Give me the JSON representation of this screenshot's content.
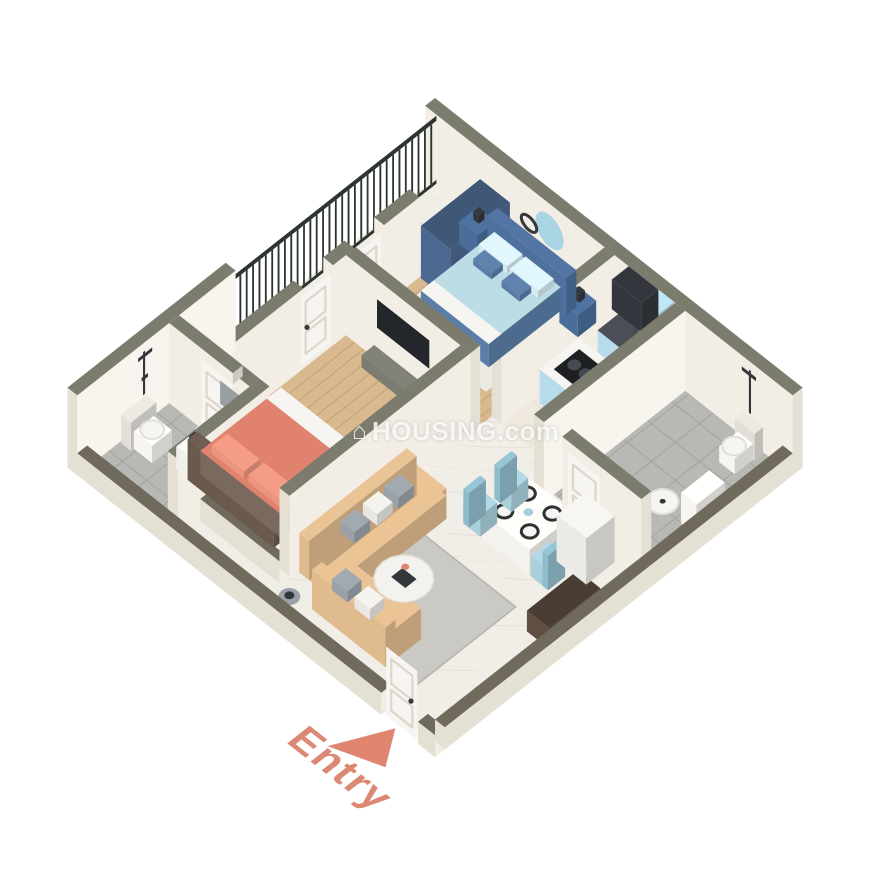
{
  "labels": {
    "entry": "Entry"
  },
  "watermark": {
    "icon": "⌂",
    "text": "HOUSING.com"
  },
  "scene": {
    "rooms": [
      "balcony",
      "bedroom-1",
      "bathroom-1",
      "bedroom-2",
      "living-dining",
      "kitchen",
      "bathroom-2",
      "entry"
    ],
    "furniture": [
      "double-bed-blue",
      "double-bed-salmon",
      "wardrobe",
      "tv-unit",
      "l-shaped-sofa",
      "coffee-table",
      "dining-table-four-chairs",
      "kitchen-island-hob",
      "kitchen-counter-sink",
      "overhead-cabinet",
      "refrigerator-cabinet",
      "toilets",
      "washbasins",
      "showers",
      "balcony-railing",
      "sideboard",
      "nightstands",
      "dresser"
    ]
  },
  "colors": {
    "background": "#ffffff",
    "wallTop": "#7b7c6e",
    "wallTopLow": "#6f6a5c",
    "wallFace": "#f2eee5",
    "wallFaceShade": "#e5e0d4",
    "wallFaceInner": "#f8f5ef",
    "floorWood": "#d9b98e",
    "floorWoodStripe": "#c2a074",
    "floorMarble": "#f1eee7",
    "floorMarbleVein": "#ddd8cc",
    "floorKitchen": "#efe9df",
    "floorKitchenLine": "#e0d9c9",
    "floorTile": "#b8b8b4",
    "floorTileLine": "#a3a39f",
    "railing": "#2c3530",
    "rugLight": "#eceae4",
    "rugGray": "#c7c5c0",
    "rugLiving": "#cbc9c4",
    "rugBorder": "#b9b7b1",
    "bedBlueFrame": "#5b7da8",
    "bedBlueHead": "#4f6f9c",
    "bedBlueBlanket": "#bcdde6",
    "bedBluePillow": "#d6ebf1",
    "bedBlueAccent": "#5a7ca6",
    "nightBlue": "#4a6d9a",
    "wardrobe": "#4d6890",
    "wardrobeTop": "#3f5878",
    "mirrorBlue": "#a8d4e4",
    "mirrorGray": "#9aa0a2",
    "darkRing": "#33363a",
    "bedSalmon": "#e0826e",
    "bedSalmonPillow": "#e9957f",
    "bedBrownHead": "#6a5a4e",
    "bedBrownFrame": "#7a695d",
    "nightWhite": "#f2f0ea",
    "tv": "#23262b",
    "console": "#7b7d72",
    "sofa": "#dfbb8e",
    "pillowGray": "#9aa2a8",
    "pillowWhite": "#e9e7e3",
    "tableWhite": "#f3f2ee",
    "plateRing": "#2f3235",
    "chairBlue": "#a9cfdb",
    "chairBlueShade": "#8fbccb",
    "cabinetBlue": "#b7dcec",
    "counterDark": "#4a4f57",
    "cabinetDark": "#33373d",
    "sink": "#c9ccd0",
    "cooktop": "#1e1f23",
    "burner": "#454a52",
    "fixtureWhite": "#f6f5f1",
    "fixtureShade": "#e1dfd8",
    "vanityBrown": "#8a7968",
    "fridgeWhite": "#eceae6",
    "sideboard": "#5f4f42",
    "sideboardTop": "#493c32",
    "dresser": "#6b5a4a",
    "door": "#f7f5f1",
    "doorPanel": "#ddd7cb",
    "handle": "#3a3a3a",
    "accent": "#e08570",
    "accentText": "#d97f68",
    "watermark": "rgba(255,255,255,0.82)"
  }
}
